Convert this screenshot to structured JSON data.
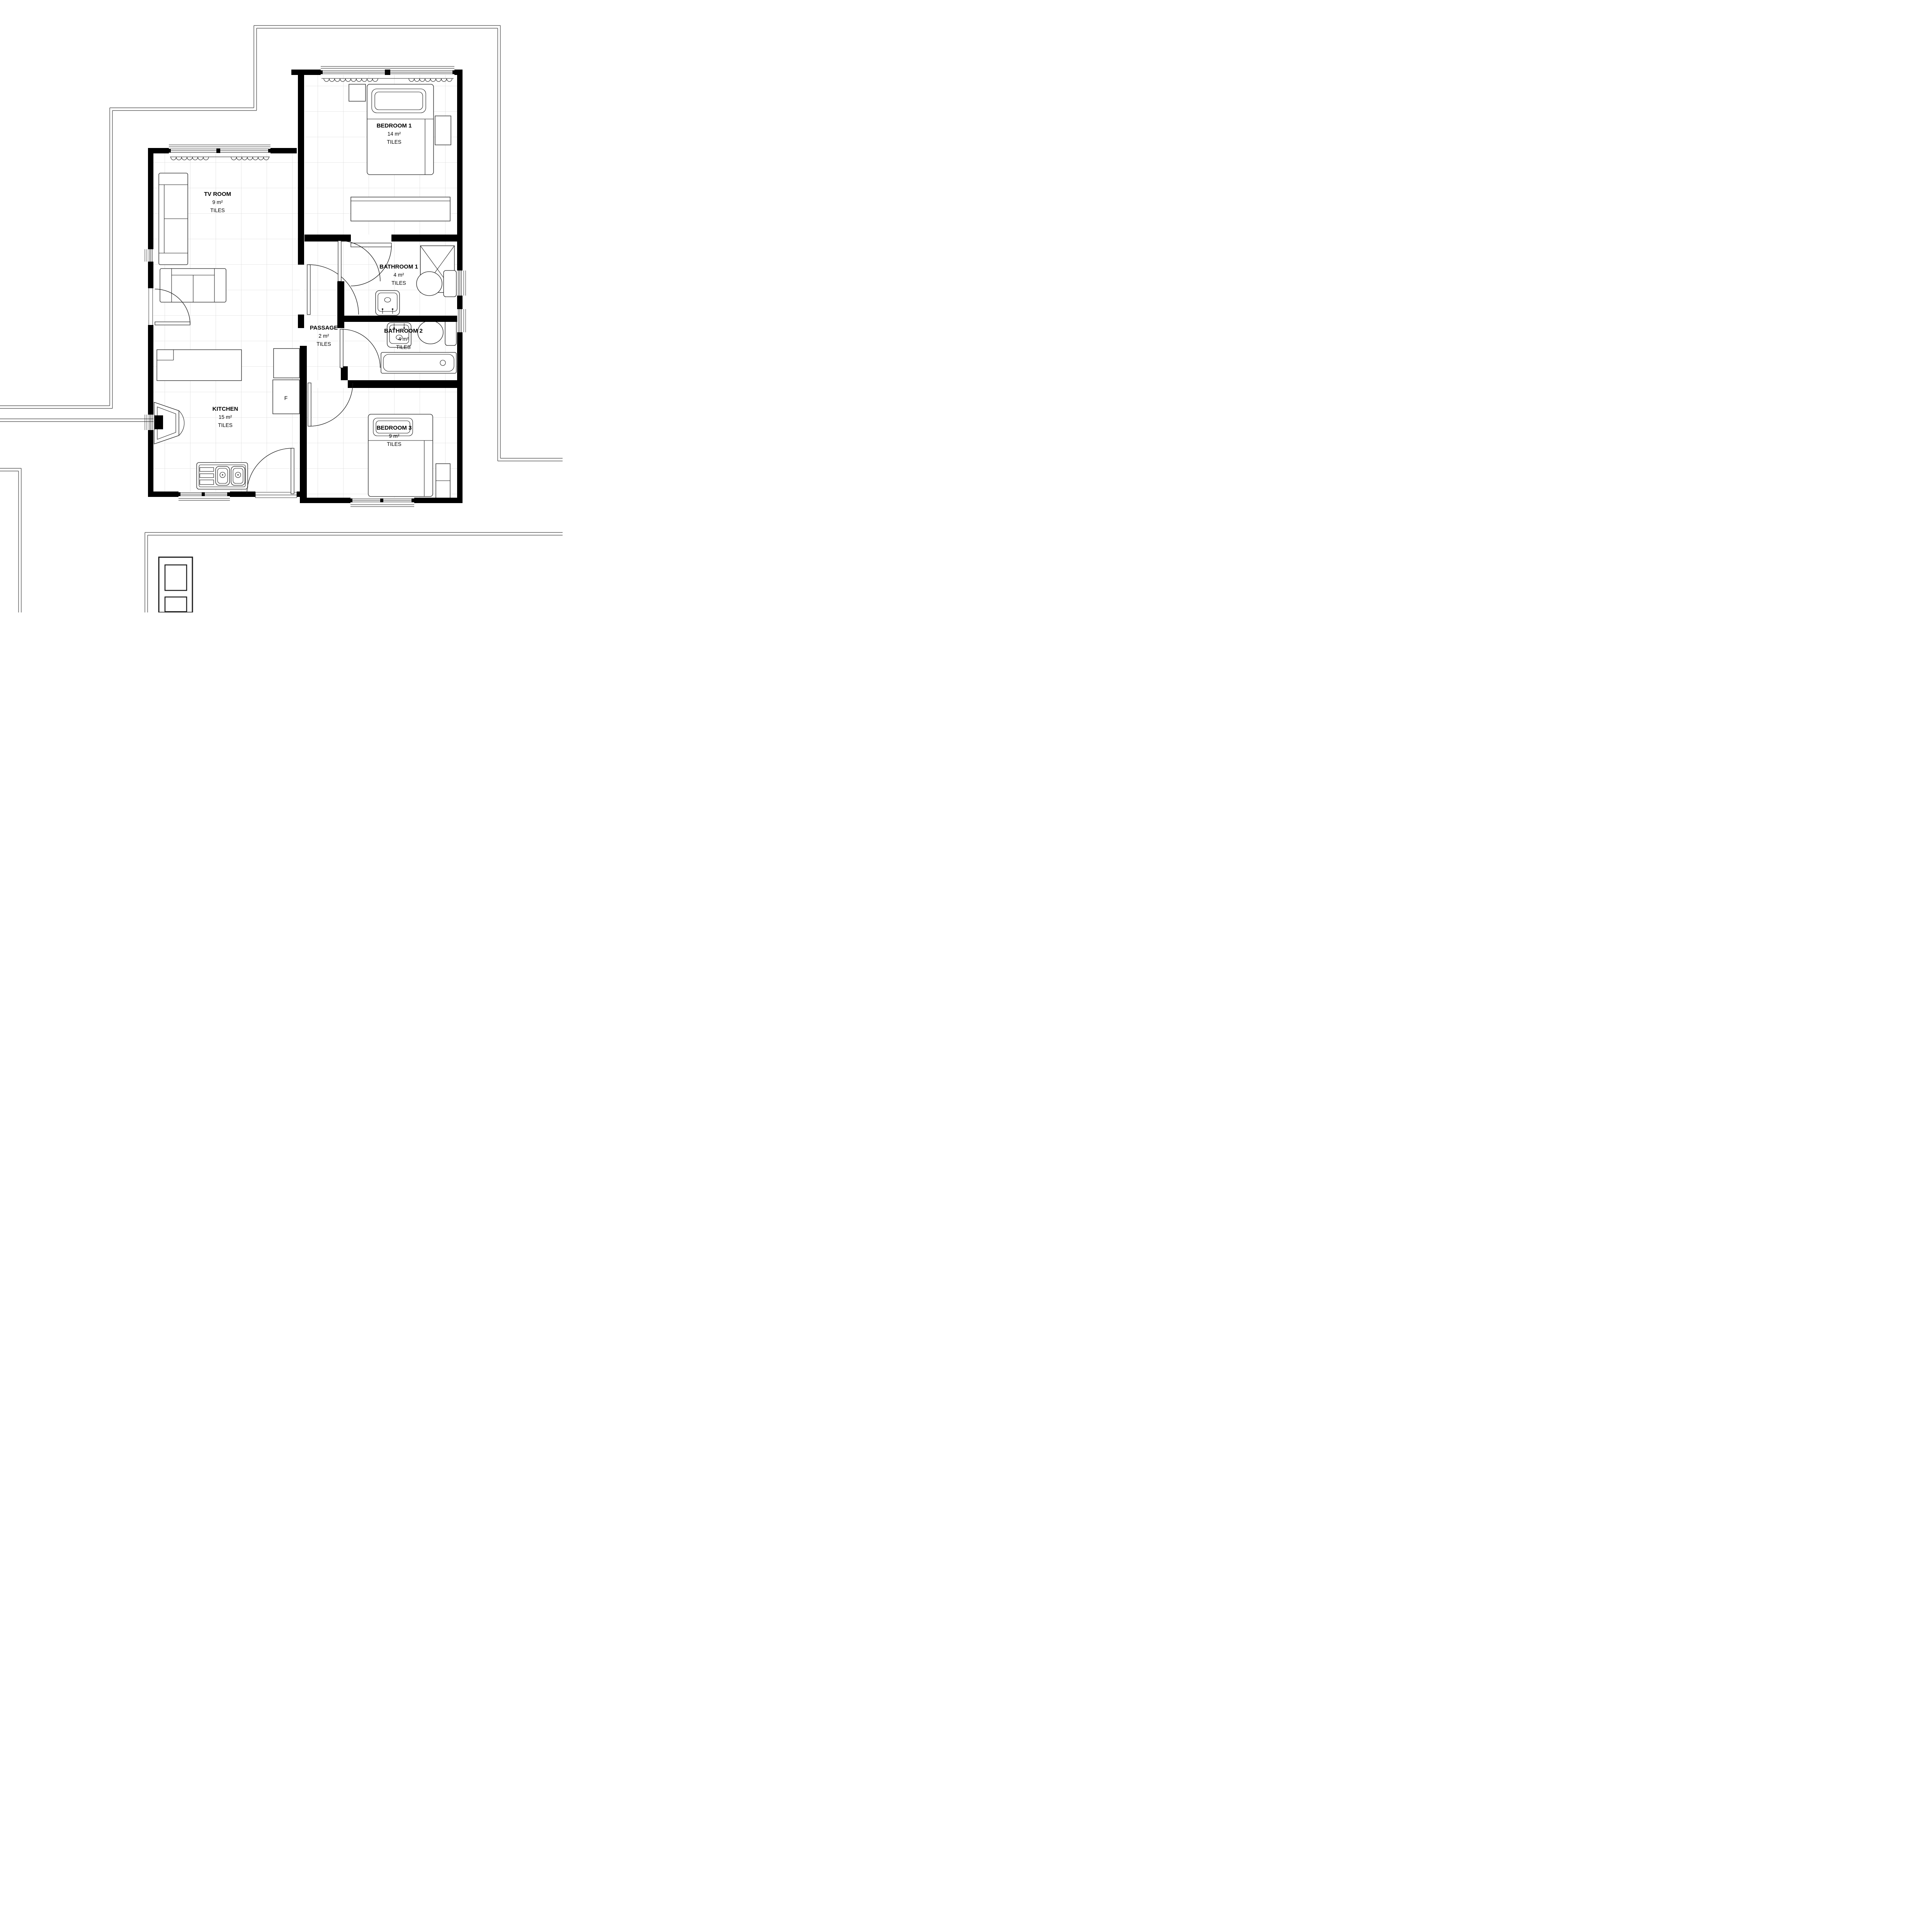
{
  "plan": {
    "title": "3-bedroom house floor plan",
    "rooms": [
      {
        "name": "BEDROOM 1",
        "area": "14 m²",
        "finish": "TILES"
      },
      {
        "name": "TV ROOM",
        "area": "9 m²",
        "finish": "TILES"
      },
      {
        "name": "BATHROOM 1",
        "area": "4 m²",
        "finish": "TILES"
      },
      {
        "name": "PASSAGE",
        "area": "2 m²",
        "finish": "TILES"
      },
      {
        "name": "BATHROOM 2",
        "area": "4 m²",
        "finish": "TILES"
      },
      {
        "name": "KITCHEN",
        "area": "15 m²",
        "finish": "TILES"
      },
      {
        "name": "BEDROOM 3",
        "area": "9 m²",
        "finish": "TILES"
      }
    ],
    "appliances": {
      "fridge_label": "F"
    },
    "colors": {
      "wall": "#000000",
      "tile_grid": "#d9d9d9",
      "boundary": "#3a3a3a",
      "line": "#1a1a1a"
    }
  }
}
